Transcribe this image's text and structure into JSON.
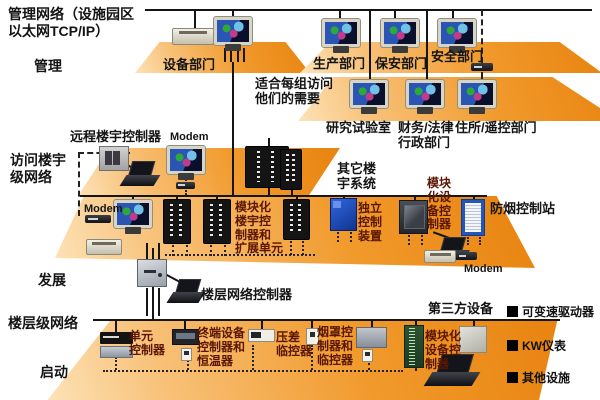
{
  "title": "管理网络（设施园区\n以太网TCP/IP）",
  "levels": {
    "management": "管理",
    "access": "访问楼宇\n级网络",
    "development": "发展",
    "floor": "楼层级网络",
    "startup": "启动"
  },
  "management": {
    "equipment_dept": "设备部门",
    "production_dept": "生产部门",
    "security_dept": "保安部门",
    "safety_dept": "安全部门",
    "note": "适合每组访问\n他们的需要",
    "research_lab": "研究试验室",
    "finance_legal": "财务/法律\n行政部门",
    "residence_dept": "住所/遥控部门"
  },
  "access": {
    "remote_building_controller": "远程楼宇控制器",
    "modem_top": "Modem",
    "modem_left": "Modem",
    "modular_building_controller": "模块化\n楼宇控\n制器和\n扩展单元",
    "other_building_systems": "其它楼\n宇系统",
    "standalone_control": "独立\n控制\n装置",
    "modular_equipment_controller": "模块\n化设\n备控\n制器",
    "smoke_control_station": "防烟控制站",
    "modem_right": "Modem"
  },
  "development": {
    "floor_network_controller": "楼层网络控制器"
  },
  "floor": {
    "third_party": "第三方设备",
    "unit_controller": "单元\n控制器",
    "terminal_controller": "终端设备\n控制器和\n恒温器",
    "pressure_monitor": "压差\n临控器",
    "hood_controller": "烟罩控\n制器和\n临控器",
    "modular_equipment_controller": "模块化\n设备控\n制器"
  },
  "legend": {
    "items": [
      "可变速驱动器",
      "KW仪表",
      "其他设施"
    ]
  },
  "colors": {
    "platform_orange": "#ee8d1f",
    "label_black": "#141414",
    "device_label_maroon": "#5a1602"
  }
}
